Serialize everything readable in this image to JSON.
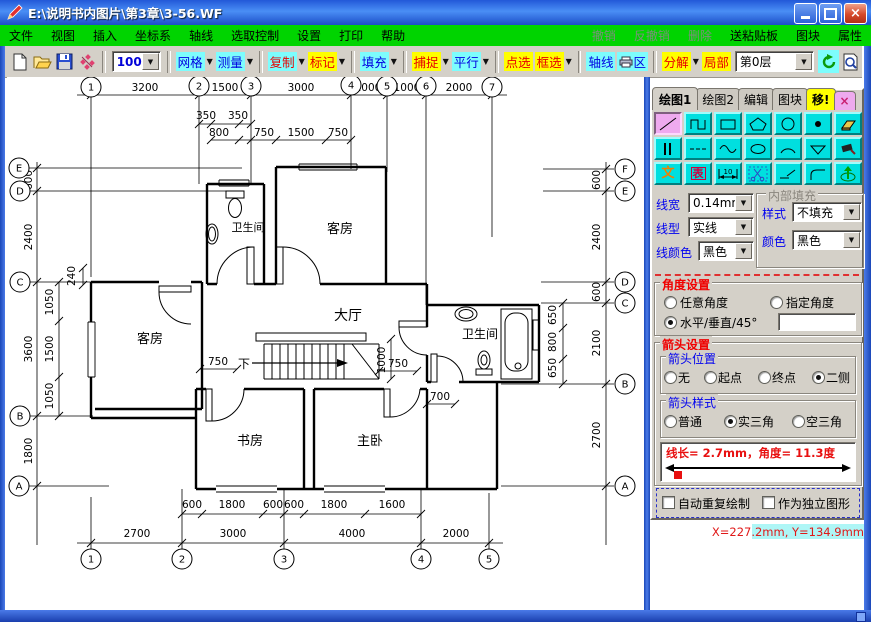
{
  "window": {
    "title": "E:\\说明书内图片\\第3章\\3-56.WF",
    "close_glyph": "×"
  },
  "menu": {
    "items": [
      "文件",
      "视图",
      "插入",
      "坐标系",
      "轴线",
      "选取控制",
      "设置",
      "打印",
      "帮助"
    ],
    "right_disabled": [
      "撤销",
      "反撤销",
      "删除"
    ],
    "right_items": [
      "送粘贴板",
      "图块",
      "属性"
    ]
  },
  "toolbar": {
    "zoom_value": "100%",
    "layer_value": "第0层",
    "buttons": {
      "grid": "网格",
      "measure": "测量",
      "copy": "复制",
      "mark": "标记",
      "fill": "填充",
      "snap": "捕捉",
      "parallel": "平行",
      "point_select": "点选",
      "box_select": "框选",
      "axis": "轴线",
      "print_area": "区",
      "explode": "分解",
      "partial": "局部"
    }
  },
  "panel": {
    "tabs": [
      "绘图1",
      "绘图2",
      "编辑",
      "图块",
      "移!"
    ],
    "close_label": "×",
    "tool_text": "文",
    "tool_table": "表",
    "tool_dim_number": "10",
    "line_width_label": "线宽",
    "line_width_value": "0.14mm",
    "line_type_label": "线型",
    "line_type_value": "实线",
    "line_color_label": "线颜色",
    "line_color_value": "黑色",
    "fill_group_title": "内部填充",
    "fill_style_label": "样式",
    "fill_style_value": "不填充",
    "fill_color_label": "颜色",
    "fill_color_value": "黑色",
    "angle_group_title": "角度设置",
    "angle_any": "任意角度",
    "angle_specified": "指定角度",
    "angle_hv45": "水平/垂直/45°",
    "arrow_group_title": "箭头设置",
    "arrow_pos_title": "箭头位置",
    "arrow_pos_none": "无",
    "arrow_pos_start": "起点",
    "arrow_pos_end": "终点",
    "arrow_pos_both": "二侧",
    "arrow_style_title": "箭头样式",
    "arrow_style_normal": "普通",
    "arrow_style_solid": "实三角",
    "arrow_style_hollow": "空三角",
    "info_text": "线长= 2.7mm，角度= 11.3度",
    "check_repeat": "自动重复绘制",
    "check_independent": "作为独立图形"
  },
  "status": {
    "coords": "X=227.2mm, Y=134.9mm"
  },
  "plan": {
    "rooms": [
      {
        "t": "客房",
        "x": 333,
        "y": 156,
        "s": 13
      },
      {
        "t": "卫生间",
        "x": 241,
        "y": 154,
        "s": 11
      },
      {
        "t": "大厅",
        "x": 341,
        "y": 243,
        "s": 14
      },
      {
        "t": "客房",
        "x": 143,
        "y": 266,
        "s": 13
      },
      {
        "t": "卫生间",
        "x": 473,
        "y": 261,
        "s": 12
      },
      {
        "t": "书房",
        "x": 243,
        "y": 368,
        "s": 13
      },
      {
        "t": "主卧",
        "x": 363,
        "y": 368,
        "s": 13
      },
      {
        "t": "下",
        "x": 237,
        "y": 291,
        "s": 12
      }
    ],
    "dims": [
      {
        "t": "3200",
        "x": 138,
        "y": 14
      },
      {
        "t": "1500",
        "x": 218,
        "y": 14
      },
      {
        "t": "3000",
        "x": 294,
        "y": 14
      },
      {
        "t": "1000",
        "x": 361,
        "y": 14
      },
      {
        "t": "1000",
        "x": 400,
        "y": 14
      },
      {
        "t": "2000",
        "x": 452,
        "y": 14
      },
      {
        "t": "350",
        "x": 199,
        "y": 42
      },
      {
        "t": "350",
        "x": 231,
        "y": 42
      },
      {
        "t": "800",
        "x": 212,
        "y": 59
      },
      {
        "t": "750",
        "x": 257,
        "y": 59
      },
      {
        "t": "1500",
        "x": 294,
        "y": 59
      },
      {
        "t": "750",
        "x": 331,
        "y": 59
      },
      {
        "t": "750",
        "x": 211,
        "y": 288
      },
      {
        "t": "750",
        "x": 391,
        "y": 290
      },
      {
        "t": "700",
        "x": 433,
        "y": 323
      },
      {
        "t": "600",
        "x": 185,
        "y": 431
      },
      {
        "t": "1800",
        "x": 225,
        "y": 431
      },
      {
        "t": "600",
        "x": 266,
        "y": 431
      },
      {
        "t": "600",
        "x": 287,
        "y": 431
      },
      {
        "t": "1800",
        "x": 327,
        "y": 431
      },
      {
        "t": "1600",
        "x": 385,
        "y": 431
      },
      {
        "t": "2700",
        "x": 130,
        "y": 460
      },
      {
        "t": "3000",
        "x": 226,
        "y": 460
      },
      {
        "t": "4000",
        "x": 345,
        "y": 460
      },
      {
        "t": "2000",
        "x": 449,
        "y": 460
      }
    ],
    "vdims": [
      {
        "t": "600",
        "x": 25,
        "y": 103
      },
      {
        "t": "2400",
        "x": 25,
        "y": 160
      },
      {
        "t": "3600",
        "x": 25,
        "y": 272
      },
      {
        "t": "1800",
        "x": 25,
        "y": 374
      },
      {
        "t": "1050",
        "x": 46,
        "y": 225
      },
      {
        "t": "1500",
        "x": 46,
        "y": 272
      },
      {
        "t": "1050",
        "x": 46,
        "y": 319
      },
      {
        "t": "240",
        "x": 68,
        "y": 199
      },
      {
        "t": "600",
        "x": 593,
        "y": 103
      },
      {
        "t": "2400",
        "x": 593,
        "y": 160
      },
      {
        "t": "600",
        "x": 593,
        "y": 215
      },
      {
        "t": "2100",
        "x": 593,
        "y": 266
      },
      {
        "t": "2700",
        "x": 593,
        "y": 358
      },
      {
        "t": "650",
        "x": 549,
        "y": 238
      },
      {
        "t": "800",
        "x": 549,
        "y": 265
      },
      {
        "t": "650",
        "x": 549,
        "y": 291
      },
      {
        "t": "1000",
        "x": 378,
        "y": 283
      }
    ],
    "bubbles": [
      {
        "t": "1",
        "x": 84,
        "y": 10
      },
      {
        "t": "2",
        "x": 192,
        "y": 9
      },
      {
        "t": "3",
        "x": 244,
        "y": 9
      },
      {
        "t": "4",
        "x": 344,
        "y": 8
      },
      {
        "t": "5",
        "x": 380,
        "y": 9
      },
      {
        "t": "6",
        "x": 419,
        "y": 9
      },
      {
        "t": "7",
        "x": 485,
        "y": 10
      },
      {
        "t": "E",
        "x": 12,
        "y": 91
      },
      {
        "t": "D",
        "x": 13,
        "y": 114
      },
      {
        "t": "C",
        "x": 13,
        "y": 205
      },
      {
        "t": "B",
        "x": 13,
        "y": 339
      },
      {
        "t": "A",
        "x": 12,
        "y": 409
      },
      {
        "t": "F",
        "x": 618,
        "y": 92
      },
      {
        "t": "E",
        "x": 618,
        "y": 114
      },
      {
        "t": "D",
        "x": 618,
        "y": 205
      },
      {
        "t": "C",
        "x": 618,
        "y": 226
      },
      {
        "t": "B",
        "x": 618,
        "y": 307
      },
      {
        "t": "A",
        "x": 618,
        "y": 409
      },
      {
        "t": "1",
        "x": 84,
        "y": 482
      },
      {
        "t": "2",
        "x": 175,
        "y": 482
      },
      {
        "t": "3",
        "x": 277,
        "y": 482
      },
      {
        "t": "4",
        "x": 414,
        "y": 482
      },
      {
        "t": "5",
        "x": 482,
        "y": 482
      }
    ],
    "ticks": [
      [
        84,
        18
      ],
      [
        192,
        18
      ],
      [
        244,
        18
      ],
      [
        344,
        18
      ],
      [
        380,
        18
      ],
      [
        419,
        18
      ],
      [
        485,
        18
      ],
      [
        192,
        47
      ],
      [
        204,
        47
      ],
      [
        232,
        47
      ],
      [
        244,
        47
      ],
      [
        204,
        63
      ],
      [
        232,
        63
      ],
      [
        244,
        63
      ],
      [
        269,
        63
      ],
      [
        319,
        63
      ],
      [
        344,
        63
      ],
      [
        175,
        437
      ],
      [
        195,
        437
      ],
      [
        256,
        437
      ],
      [
        277,
        437
      ],
      [
        297,
        437
      ],
      [
        358,
        437
      ],
      [
        414,
        437
      ],
      [
        84,
        466
      ],
      [
        175,
        466
      ],
      [
        277,
        466
      ],
      [
        414,
        466
      ],
      [
        482,
        466
      ],
      [
        30,
        91
      ],
      [
        30,
        114
      ],
      [
        30,
        205
      ],
      [
        30,
        339
      ],
      [
        30,
        409
      ],
      [
        52,
        205
      ],
      [
        52,
        244
      ],
      [
        52,
        300
      ],
      [
        52,
        339
      ],
      [
        599,
        92
      ],
      [
        599,
        114
      ],
      [
        599,
        205
      ],
      [
        599,
        226
      ],
      [
        599,
        307
      ],
      [
        599,
        409
      ],
      [
        556,
        226
      ],
      [
        556,
        251
      ],
      [
        556,
        282
      ],
      [
        556,
        307
      ],
      [
        384,
        262
      ],
      [
        384,
        302
      ],
      [
        193,
        292
      ],
      [
        230,
        292
      ],
      [
        372,
        294
      ],
      [
        410,
        294
      ],
      [
        420,
        327
      ],
      [
        448,
        327
      ],
      [
        76,
        191
      ],
      [
        76,
        208
      ]
    ]
  }
}
